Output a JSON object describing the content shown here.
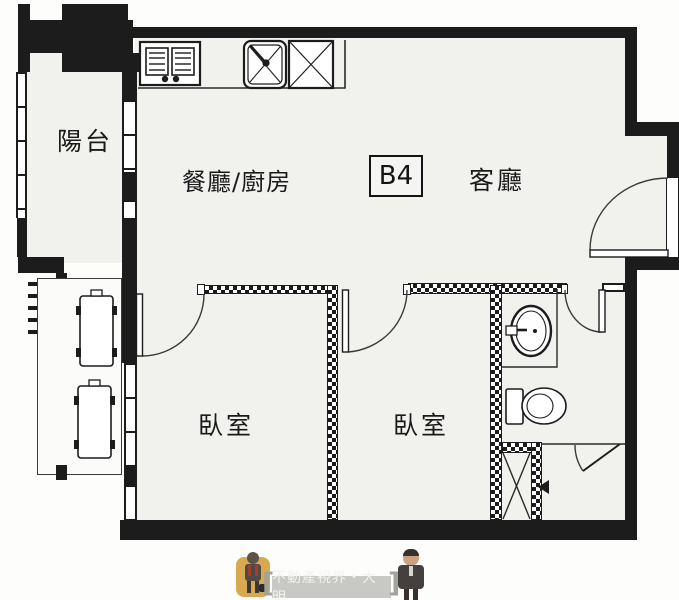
{
  "unit": {
    "label": "B4"
  },
  "rooms": {
    "balcony": "陽台",
    "dining_kitchen": "餐廳/廚房",
    "living": "客廳",
    "bedroom1": "臥室",
    "bedroom2": "臥室"
  },
  "watermark": {
    "text": "不動產視界・大明",
    "bracket_left": "[",
    "bracket_right": "]"
  },
  "fixtures": {
    "stove": "stove-2-burner-icon",
    "kitchen_sink": "kitchen-sink-icon",
    "counter_unit": "counter-x-unit-icon",
    "ac_units": "ac-outdoor-unit-icon",
    "bath_sink": "bathroom-sink-icon",
    "toilet": "toilet-icon",
    "pipe_shaft": "pipe-shaft-icon",
    "doors": "door-swing-icon"
  },
  "colors": {
    "wall": "#1c1c1c",
    "floor": "#f1f1ee",
    "hatch_wall": "#1c1c1c",
    "watermark_plate": "#c8c8c4",
    "avatar_left_bg": "#d9a94f"
  }
}
